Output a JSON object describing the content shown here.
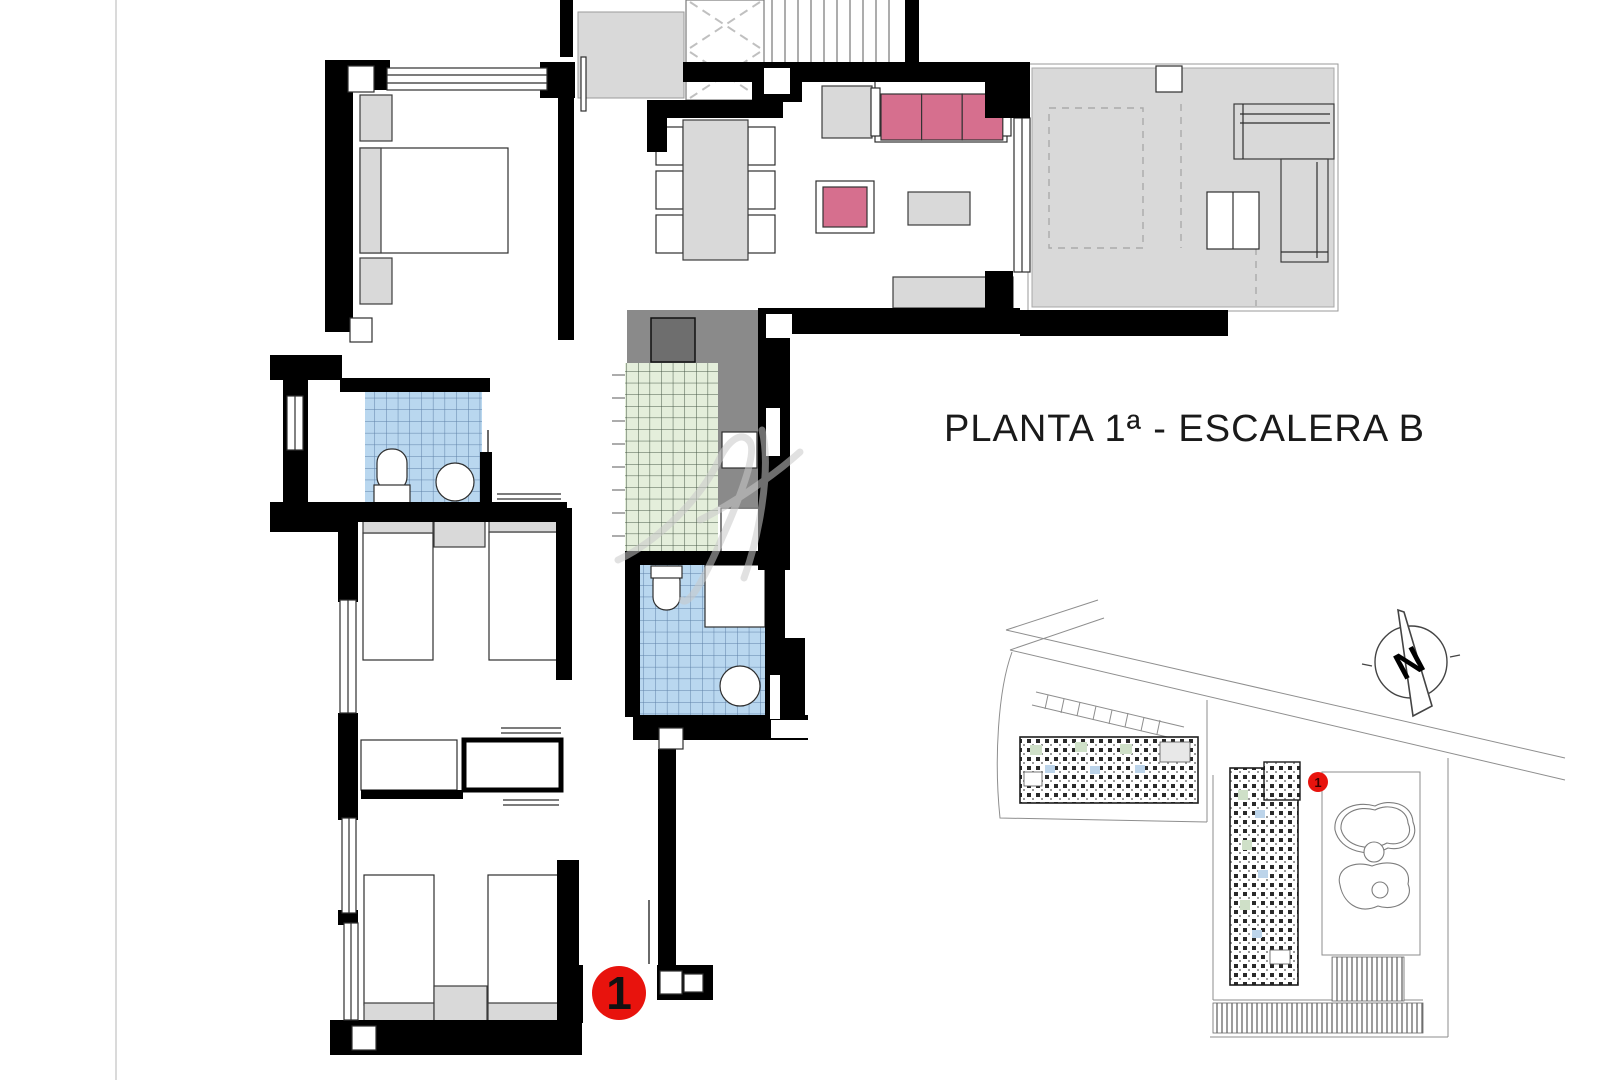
{
  "title": {
    "text": "PLANTA 1ª - ESCALERA B"
  },
  "floor_plan": {
    "unit_marker": "1"
  },
  "site_plan": {
    "unit_marker": "1",
    "north_label": "N"
  },
  "colors": {
    "wall": "#000000",
    "marker_red": "#e8130d",
    "sofa_pink": "#d66f8e",
    "tile_blue": "#b9d7ef",
    "tile_blue_line": "#5e81a8",
    "tile_green": "#e4eedb",
    "tile_green_line": "#465746",
    "terrace_gray": "#d9d9d9",
    "counter_gray": "#8a8a8a",
    "furniture_gray": "#d9d9d9",
    "appliance_gray": "#6e6e6e",
    "boundary_gray": "#8e8e8e",
    "watermark_gray": "#c9c9c9",
    "title_text": "#1a1a1a"
  }
}
